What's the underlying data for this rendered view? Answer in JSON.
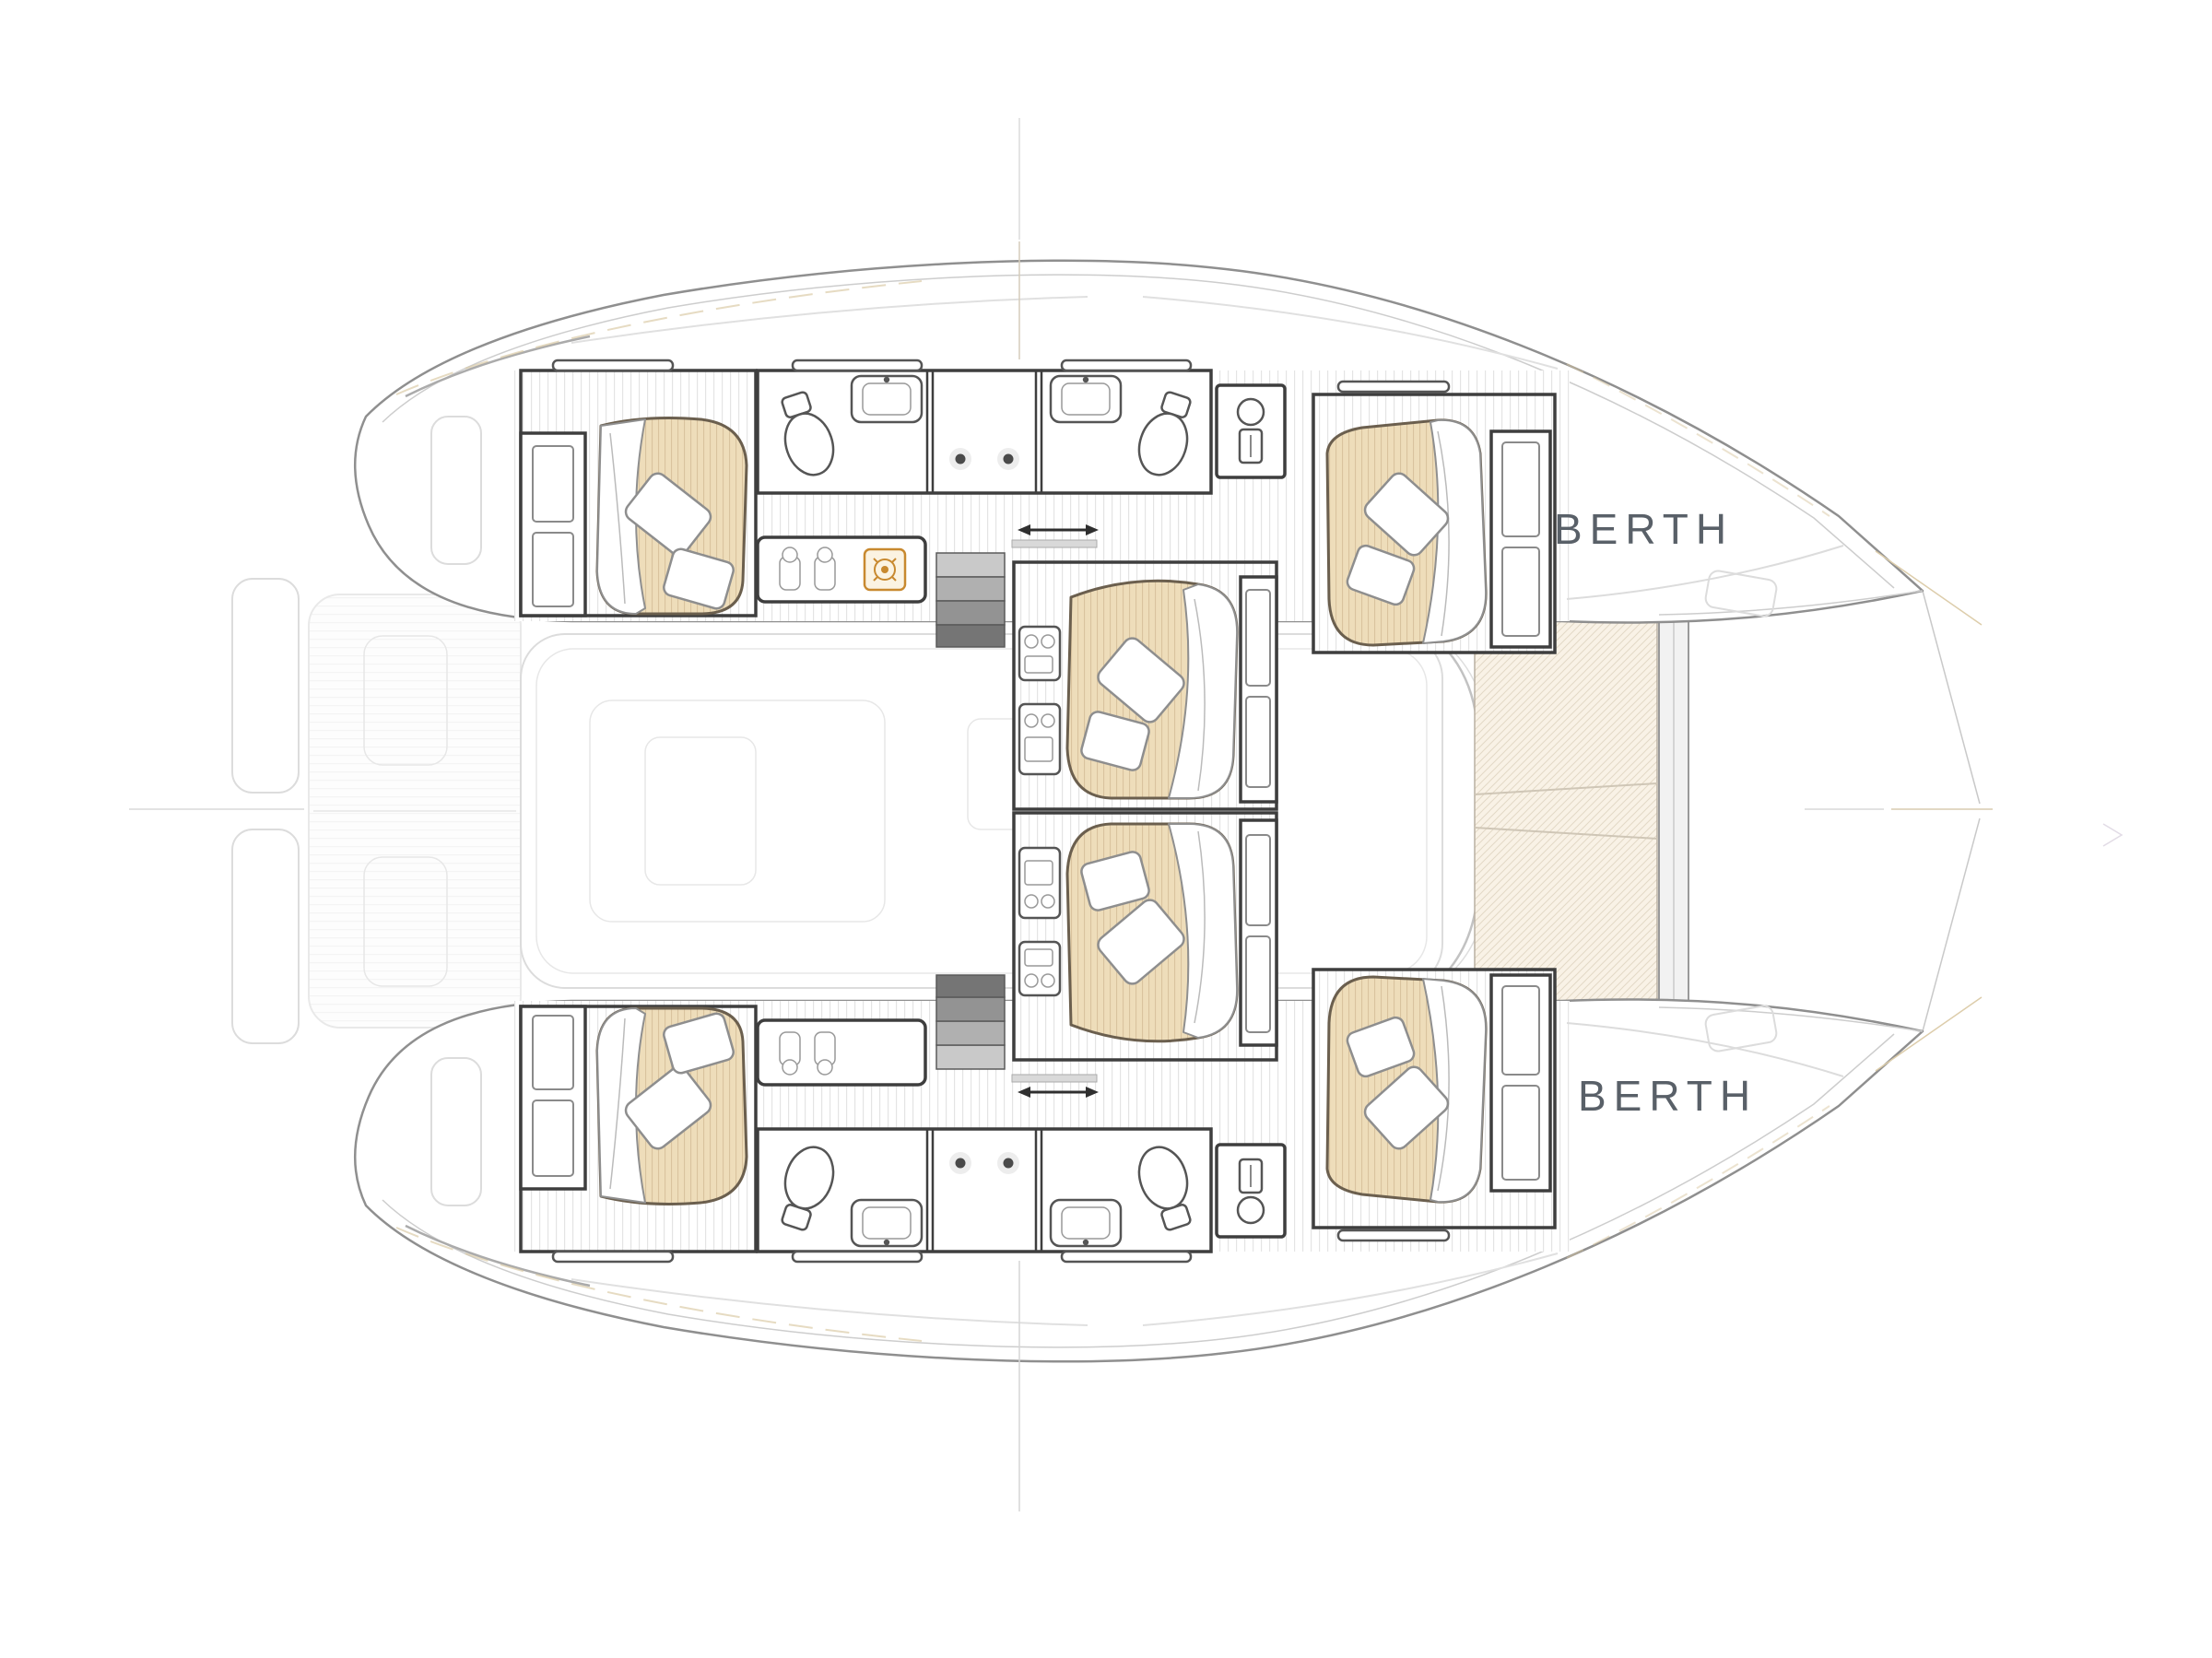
{
  "diagram": {
    "type": "yacht-floorplan",
    "title": "Catamaran lower-deck cabin layout plan",
    "labels": {
      "berth_fore_port": "BERTH",
      "berth_fore_starboard": "BERTH"
    },
    "palette": {
      "hull_stroke": "#8f8f8f",
      "wall": "#3e3e3e",
      "mattress": "#eeddba",
      "mattress_stroke": "#6b5f4e",
      "trampoline": "#f9f2e6",
      "accent_tan": "#d9c7a2",
      "accent_orange": "#c8892f",
      "label": "#596068",
      "faint_outline": "#dcdcdc"
    },
    "features": {
      "cabins": [
        "aft-cabin-port",
        "midship-cabin-port",
        "forward-cabin-port",
        "aft-cabin-starboard",
        "midship-cabin-starboard",
        "forward-cabin-starboard"
      ],
      "bathrooms": [
        "head-port-aft",
        "head-port-fwd",
        "head-starboard-aft",
        "head-starboard-fwd"
      ],
      "icons": [
        "toilet-icon",
        "sink-icon",
        "vanity-knob-icon",
        "water-heater-icon",
        "galley-jar-icon",
        "stove-burner-icon",
        "companionway-steps",
        "sliding-door-arrow",
        "pillow",
        "duvet",
        "trampoline-net",
        "crosshair-mark"
      ]
    }
  }
}
